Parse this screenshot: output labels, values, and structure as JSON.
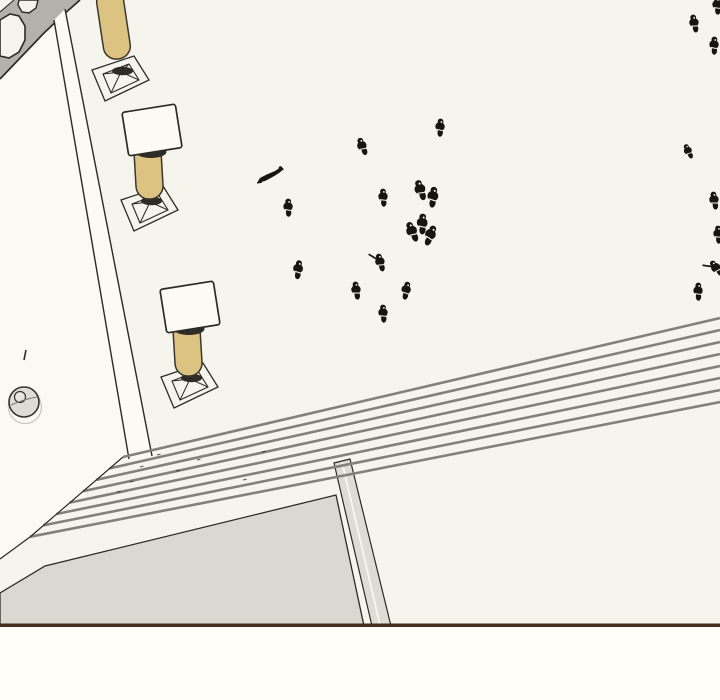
{
  "scene": {
    "colors": {
      "page_bg": "#fffef9",
      "plaza": "#f6f5ed",
      "left_ground": "#faf9f2",
      "walkway_strip": "#fbfaf4",
      "structure_gray": "#b4b1ab",
      "structure_white": "#f5f4ec",
      "ink": "#2b2a26",
      "column_fill": "#ddc382",
      "column_ink": "#3a372e",
      "capital_fill": "#fbfaf5",
      "stair_line": "#82817c",
      "terrace_fill": "#d9d8d1",
      "curb_fill": "#dddcd5",
      "well_fill": "#dedcd4",
      "figure_ink": "#171511",
      "border_brown": "#45301f"
    },
    "panel": {
      "x": 0,
      "y": 0,
      "w": 720,
      "h": 626,
      "border_h": 3.5
    },
    "structure": {
      "body": [
        [
          0,
          0
        ],
        [
          80,
          0
        ],
        [
          63,
          15
        ],
        [
          44,
          33
        ],
        [
          0,
          79
        ]
      ],
      "edge": [
        [
          0,
          79
        ],
        [
          44,
          33
        ],
        [
          63,
          15
        ],
        [
          80,
          0
        ]
      ],
      "corner_strip": [
        [
          0,
          0
        ],
        [
          14,
          0
        ],
        [
          0,
          12
        ]
      ],
      "arch_big": [
        [
          0,
          20
        ],
        [
          10,
          14
        ],
        [
          19,
          16
        ],
        [
          25,
          26
        ],
        [
          25,
          40
        ],
        [
          19,
          52
        ],
        [
          9,
          58
        ],
        [
          0,
          56
        ]
      ],
      "arch_small": [
        [
          19,
          0
        ],
        [
          38,
          0
        ],
        [
          36,
          8
        ],
        [
          29,
          13
        ],
        [
          22,
          12
        ],
        [
          18,
          5
        ]
      ]
    },
    "walkway": {
      "left_ground": [
        [
          0,
          79
        ],
        [
          54,
          20
        ],
        [
          129,
          459
        ],
        [
          30,
          537
        ],
        [
          0,
          559
        ]
      ],
      "strip": [
        [
          54,
          20
        ],
        [
          65,
          9
        ],
        [
          152,
          456
        ],
        [
          129,
          459
        ]
      ],
      "line_a": [
        [
          54,
          20
        ],
        [
          129,
          459
        ]
      ],
      "line_b": [
        [
          65,
          9
        ],
        [
          152,
          456
        ]
      ]
    },
    "terrace": {
      "outline": [
        [
          0,
          593
        ],
        [
          45,
          566
        ],
        [
          336,
          495
        ],
        [
          364,
          626
        ],
        [
          0,
          626
        ]
      ]
    },
    "curb": {
      "outline": [
        [
          334,
          463
        ],
        [
          350,
          459
        ],
        [
          391,
          626
        ],
        [
          372,
          626
        ]
      ],
      "highlight": [
        [
          342,
          462
        ],
        [
          380,
          625
        ]
      ]
    },
    "stairs": {
      "count": 8,
      "left_x": 123,
      "left_y": 457,
      "left_dx": -13.3,
      "left_dy": 11.4,
      "right_x": 720,
      "right_y0": 318,
      "right_dy": 12,
      "line_width": 2.6,
      "left_edge": [
        [
          123,
          457
        ],
        [
          30,
          537
        ]
      ],
      "bottom_left_edge": [
        [
          30,
          537
        ],
        [
          0,
          559
        ]
      ],
      "tread_marks": [
        [
          140,
          467
        ],
        [
          130,
          482
        ],
        [
          157,
          455
        ],
        [
          117,
          492
        ],
        [
          176,
          471
        ],
        [
          197,
          460
        ],
        [
          243,
          480
        ],
        [
          262,
          452
        ]
      ]
    },
    "columns": [
      {
        "x": 121,
        "y": 79,
        "shaft": {
          "x1": 109,
          "y1": -6,
          "x2": 118,
          "y2": 54
        },
        "cap": null
      },
      {
        "x": 150,
        "y": 209,
        "shaft": {
          "x1": 147,
          "y1": 143,
          "x2": 150,
          "y2": 194
        },
        "cap": {
          "x": 152,
          "y": 130
        }
      },
      {
        "x": 190,
        "y": 386,
        "shaft": {
          "x1": 186,
          "y1": 321,
          "x2": 189,
          "y2": 371
        },
        "cap": {
          "x": 190,
          "y": 307
        }
      }
    ],
    "well": {
      "ring": {
        "cx": 25,
        "cy": 407,
        "r": 16.5
      },
      "basin": {
        "cx": 24,
        "cy": 402,
        "r": 15
      },
      "inner": {
        "cx": 20,
        "cy": 397,
        "r": 5.5
      },
      "mark": [
        [
          26,
          350
        ],
        [
          24,
          360
        ]
      ]
    },
    "figures": [
      {
        "x": 362,
        "y": 146,
        "kind": "person",
        "rot": -18,
        "scale": 1
      },
      {
        "x": 440,
        "y": 127,
        "kind": "person",
        "rot": 6,
        "scale": 1
      },
      {
        "x": 273,
        "y": 174,
        "kind": "cloak",
        "rot": 0,
        "scale": 1
      },
      {
        "x": 288,
        "y": 207,
        "kind": "person",
        "rot": 2,
        "scale": 1
      },
      {
        "x": 383,
        "y": 197,
        "kind": "person",
        "rot": 0,
        "scale": 1
      },
      {
        "x": 427,
        "y": 193,
        "kind": "group2",
        "rot": 0,
        "scale": 1.15
      },
      {
        "x": 421,
        "y": 229,
        "kind": "group3",
        "rot": 0,
        "scale": 1.15
      },
      {
        "x": 298,
        "y": 269,
        "kind": "person",
        "rot": 10,
        "scale": 1.05
      },
      {
        "x": 380,
        "y": 262,
        "kind": "person_arm",
        "rot": -12,
        "scale": 1
      },
      {
        "x": 356,
        "y": 290,
        "kind": "person",
        "rot": -5,
        "scale": 1
      },
      {
        "x": 406,
        "y": 290,
        "kind": "person",
        "rot": 14,
        "scale": 1
      },
      {
        "x": 383,
        "y": 313,
        "kind": "person",
        "rot": 0,
        "scale": 1
      },
      {
        "x": 694,
        "y": 23,
        "kind": "person",
        "rot": -8,
        "scale": 1
      },
      {
        "x": 717,
        "y": 5,
        "kind": "person",
        "rot": 0,
        "scale": 1
      },
      {
        "x": 714,
        "y": 45,
        "kind": "person",
        "rot": 4,
        "scale": 1
      },
      {
        "x": 688,
        "y": 151,
        "kind": "person",
        "rot": -22,
        "scale": 0.85
      },
      {
        "x": 714,
        "y": 200,
        "kind": "person",
        "rot": -6,
        "scale": 1
      },
      {
        "x": 718,
        "y": 234,
        "kind": "person",
        "rot": 0,
        "scale": 1
      },
      {
        "x": 716,
        "y": 268,
        "kind": "person_arm",
        "rot": -35,
        "scale": 1
      },
      {
        "x": 698,
        "y": 291,
        "kind": "person",
        "rot": 3,
        "scale": 1
      }
    ]
  }
}
